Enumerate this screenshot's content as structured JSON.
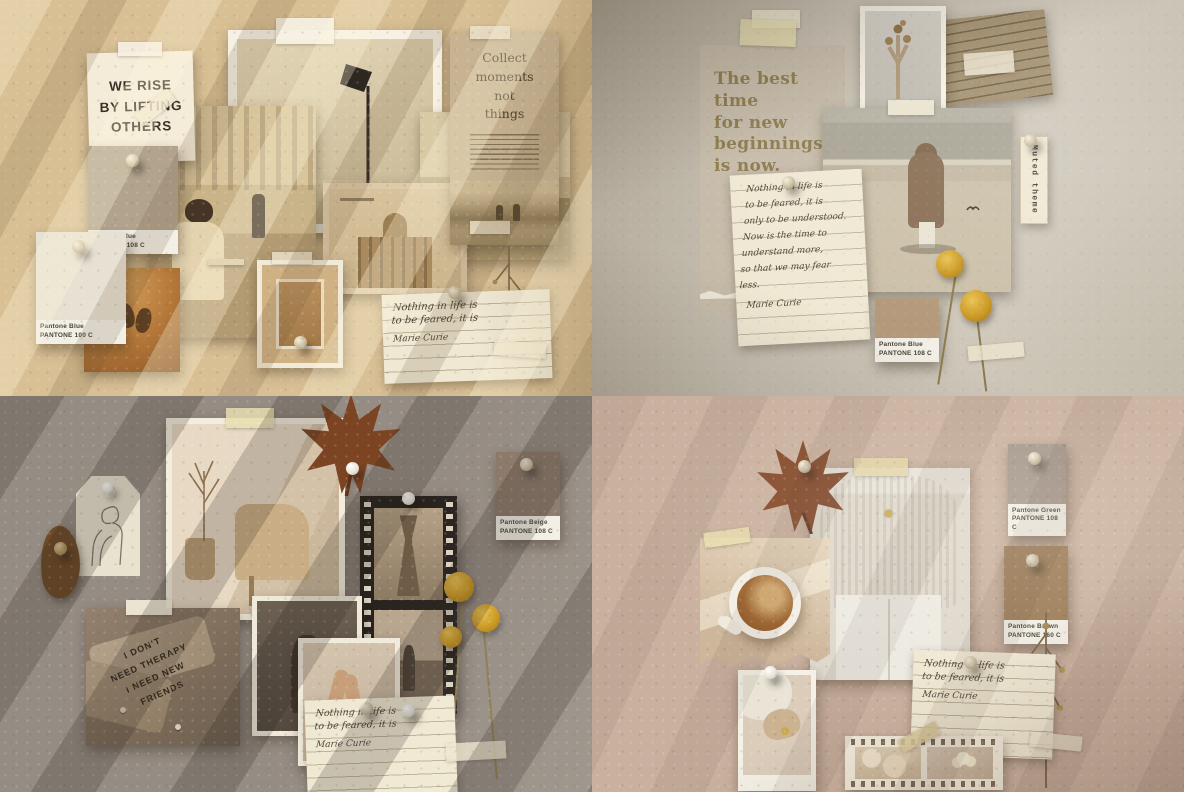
{
  "q1": {
    "poster_text": "WE RISE\nBY LIFTING\nOTHERS",
    "collect_title": "Collect\nmoments\nnot\nthings",
    "swatch_top": {
      "name": "Pantone Blue",
      "code": "PANTONE 108 C"
    },
    "swatch_bottom": {
      "name": "Pantone Blue",
      "code": "PANTONE 100 C"
    },
    "note": {
      "text": "Nothing in life is\nto be feared, it is",
      "signature": "Marie Curie"
    }
  },
  "q2": {
    "quote_text": "The best\ntime\nfor new\nbeginnings\nis now.",
    "tag_label": "Muted theme",
    "note": {
      "text": "Nothing in life is\nto be feared, it is\nonly to be understood.\nNow is the time to\nunderstand more,\nso that we may fear\nless.",
      "signature": "Marie Curie"
    },
    "swatch": {
      "name": "Pantone Blue",
      "code": "PANTONE 108 C"
    }
  },
  "q3": {
    "swatch": {
      "name": "Pantone Beige",
      "code": "PANTONE 108 C"
    },
    "shirt_text": "I DON'T\nNEED THERAPY\nI NEED NEW\nFRIENDS",
    "note": {
      "text": "Nothing in life is\nto be feared, it is",
      "signature": "Marie Curie"
    }
  },
  "q4": {
    "swatch_green": {
      "name": "Pantone Green",
      "code": "PANTONE 108 C"
    },
    "swatch_brown": {
      "name": "Pantone Brown",
      "code": "PANTONE 160 C"
    },
    "note": {
      "text": "Nothing in life is\nto be feared, it is",
      "signature": "Marie Curie"
    }
  },
  "colors": {
    "board_q1": "#d8bf94",
    "board_q2": "#c6bfb1",
    "board_q3": "#958c83",
    "board_q4": "#cab19f",
    "swatch_q1_top": "#b2a38d",
    "swatch_q1_bottom": "#e7e1d3",
    "swatch_q2": "#b39879",
    "swatch_q3_beige": "#8a7869",
    "swatch_q4_green": "#a4968a",
    "swatch_q4_brown": "#9c7c57",
    "craspedia_yellow": "#d0a02a",
    "maple_leaf": "#7c4423"
  }
}
